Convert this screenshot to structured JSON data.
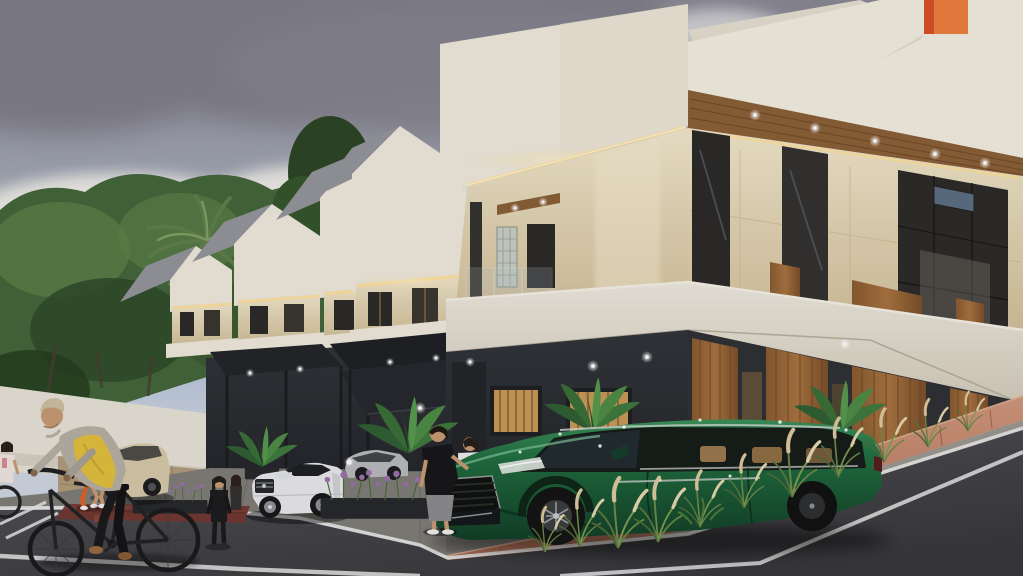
{
  "meta": {
    "type": "architectural-render",
    "width": 1023,
    "height": 576,
    "description": "Exterior 3D visualization of a row of modern gabled townhouses stepping up a sloped street, dusk lighting with warm LED strips, landscaping, vehicles and pedestrians."
  },
  "palette": {
    "sky-top": "#8c8a94",
    "sky-mid": "#a2a7b6",
    "sky-blue": "#9db0d2",
    "sky-low": "#c9d2e0",
    "cloud-dark": "#7f7d89",
    "cloud-white": "#eceae6",
    "foliage-dark": "#2e4a28",
    "foliage-mid": "#44673a",
    "foliage-light": "#5d8148",
    "palm-green": "#5e7f4a",
    "trunk": "#7a6a52",
    "house-white": "#efe9dd",
    "house-shade": "#e0d8c6",
    "roof-gray": "#95969b",
    "travertine": "#e6d8b6",
    "travertine-deep": "#d2c09a",
    "wood": "#a97440",
    "wood-dark": "#6b4526",
    "soffit-wood": "#8a5f36",
    "dark-floor": "#32353a",
    "dark-floor2": "#24262b",
    "pergola": "#232529",
    "led": "#ffe2a0",
    "led-bright": "#fff3d2",
    "glass-dark": "#2b2a29",
    "glass-refl": "#707684",
    "stone-wall": "#b39b7c",
    "wall-white": "#e7e3d8",
    "road": "#55555a",
    "road-dark": "#38383c",
    "line-white": "#e8e8e8",
    "curb-brick": "#b06c55",
    "curb-brick-light": "#d0987d",
    "sidewalk": "#807d78",
    "planter-dark": "#26282b",
    "lavender": "#9e6fb0",
    "grass-green": "#6f8c4c",
    "grass-plume": "#dbc9a0",
    "suv-green": "#1f6b3f",
    "suv-green-dark": "#123f26",
    "suv-green-light": "#3a9159",
    "tan-interior": "#b3895a",
    "car-white": "#e9e9eb",
    "car-cream": "#d7c9a9",
    "car-silver": "#b9babe",
    "skin": "#c89a74",
    "orange-outfit": "#e06227",
    "yellow-vest": "#e3bf3d",
    "jacket-gray": "#b6b0a4",
    "beanie": "#cec0a2",
    "black-cloth": "#1c1c1e",
    "white-cloth": "#ececec",
    "chimney-orange": "#ee7f3e",
    "chimney-red": "#d94f27",
    "bin-green": "#3f8040"
  },
  "objects": [
    {
      "name": "sky",
      "label": "Overcast sky with gray and white clouds"
    },
    {
      "name": "tree-mass",
      "label": "Dense green trees behind perimeter wall"
    },
    {
      "name": "palm-tree",
      "label": "Tall palm tree"
    },
    {
      "name": "perimeter-wall",
      "label": "White wall with stone base"
    },
    {
      "name": "townhouse-row",
      "label": "Five stepped gabled townhouses with LED accent lighting"
    },
    {
      "name": "orange-chimney",
      "label": "Orange accent chimney on nearest roof"
    },
    {
      "name": "carports",
      "label": "Dark steel carport pergolas with downlights"
    },
    {
      "name": "suv-green",
      "label": "Dark green luxury SUV parked in driveway"
    },
    {
      "name": "sedan-white",
      "label": "White luxury sedan parked at curb"
    },
    {
      "name": "hatchback-cream",
      "label": "Cream car parked beyond wall"
    },
    {
      "name": "car-silver",
      "label": "Silver car under carport"
    },
    {
      "name": "cyclist",
      "label": "Elderly cyclist in yellow vest and beanie"
    },
    {
      "name": "joggers",
      "label": "Two women jogging"
    },
    {
      "name": "pedestrians",
      "label": "People walking near the houses and SUV"
    },
    {
      "name": "road",
      "label": "Asphalt street sloping up to the right with white edge lines"
    },
    {
      "name": "brick-walkway",
      "label": "Red brick paver walkway along the rising curb"
    },
    {
      "name": "planters",
      "label": "Planters with lavender, banana plants and ornamental grasses"
    },
    {
      "name": "trash-bin",
      "label": "Green wheelie bin"
    }
  ]
}
